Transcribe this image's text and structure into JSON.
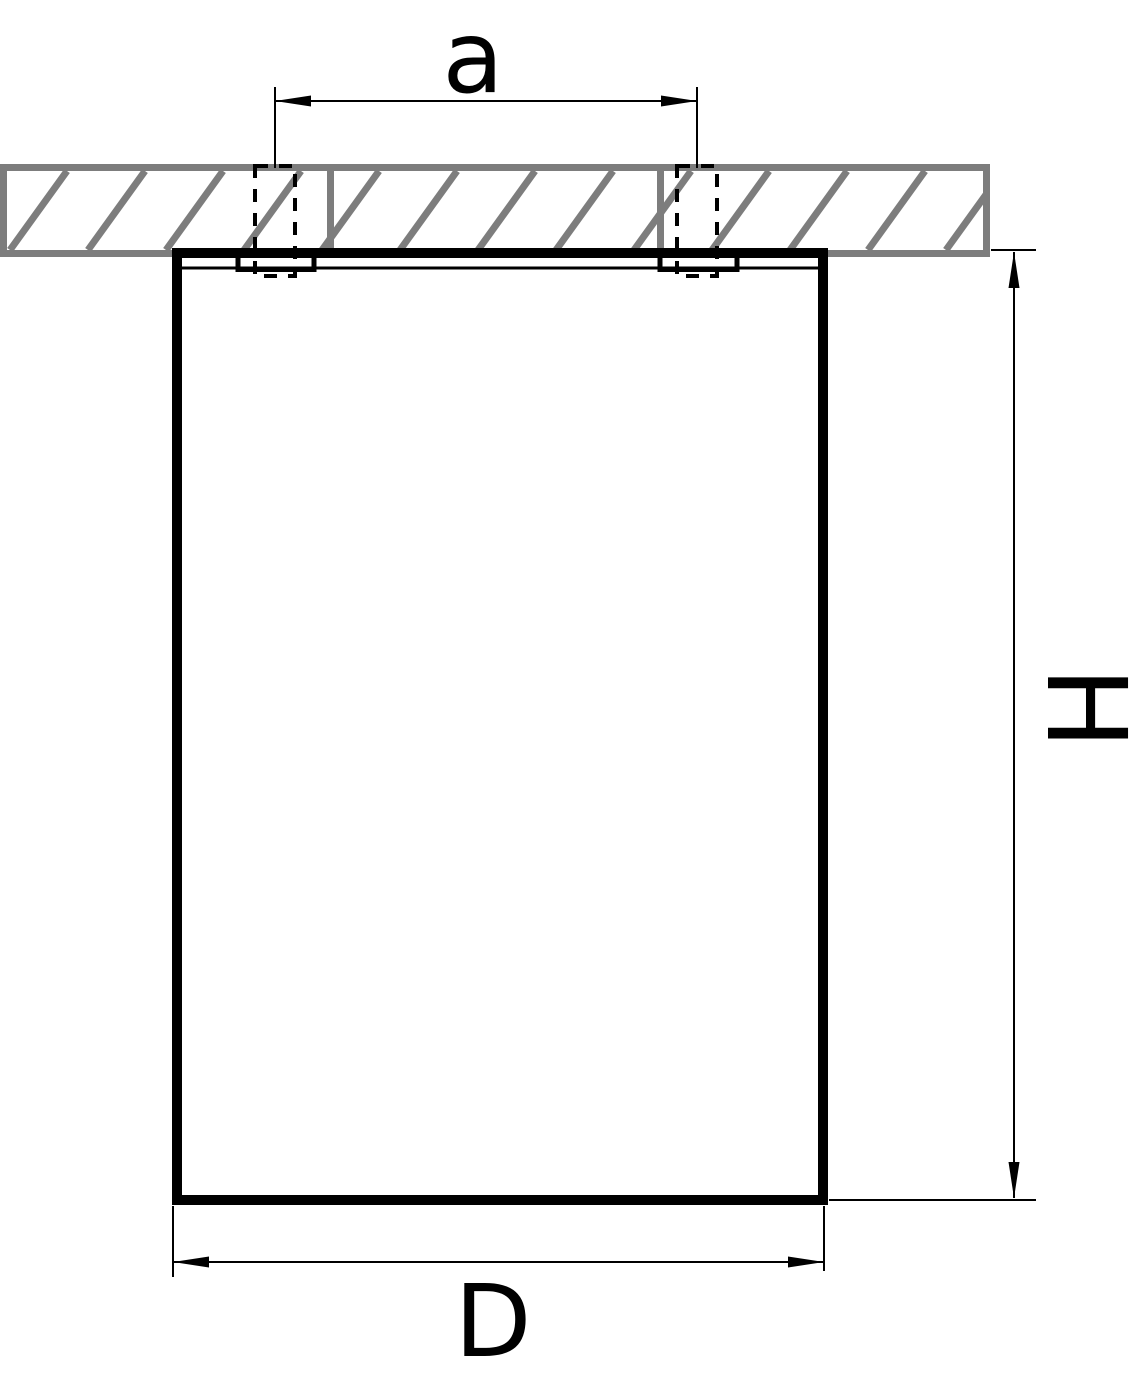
{
  "drawing": {
    "type": "technical-dimension-drawing",
    "subject": "ceiling-mounted fixture, side section view",
    "labels": {
      "hole_spacing": "a",
      "height": "H",
      "width": "D"
    },
    "colors": {
      "outline": "#000000",
      "ceiling_hatch": "#7d7d7d",
      "background": "#ffffff"
    }
  }
}
